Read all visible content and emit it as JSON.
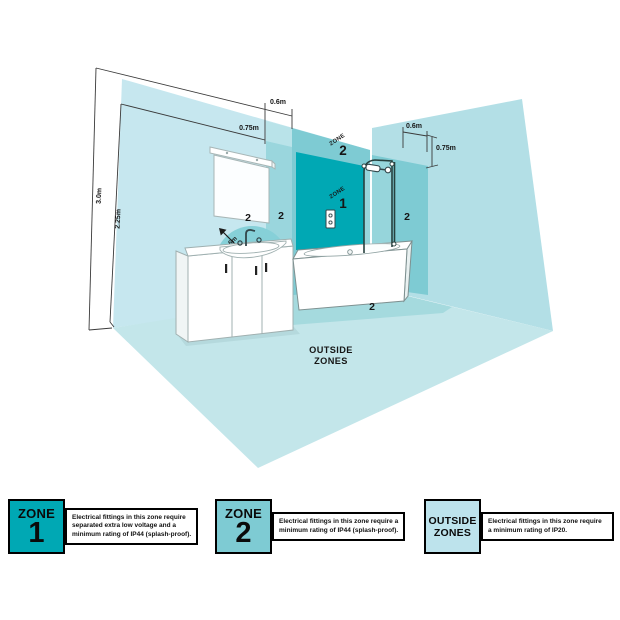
{
  "diagram": {
    "dimensions": {
      "left_top_width": "0.6m",
      "left_top_drop": "0.75m",
      "wall_height": "3.0m",
      "zone_height": "2.25m",
      "right_top_width": "0.6m",
      "right_top_drop": "0.75m",
      "basin_radius": "0.6m"
    },
    "zone1": {
      "word": "ZONE",
      "number": "1"
    },
    "zone2": {
      "word": "ZONE",
      "number": "2"
    },
    "markers": {
      "semicircle": "2",
      "left_strip": "2",
      "right_band": "2",
      "floor": "2"
    },
    "outside_zones": {
      "line1": "OUTSIDE",
      "line2": "ZONES"
    }
  },
  "legend": {
    "zone1": {
      "word": "ZONE",
      "number": "1",
      "lines": [
        "Electrical fittings in this zone require",
        "separated extra low voltage and a",
        "minimum rating of IP44 (splash-proof)."
      ]
    },
    "zone2": {
      "word": "ZONE",
      "number": "2",
      "lines": [
        "Electrical fittings in this zone require a",
        "minimum rating of IP44 (splash-proof)."
      ]
    },
    "outside": {
      "line1": "OUTSIDE",
      "line2": "ZONES",
      "lines": [
        "Electrical fittings in this zone require",
        "a minimum rating of IP20."
      ]
    }
  },
  "colors": {
    "zone1_teal": "#00a8b4",
    "zone2_teal": "#7ecbd3",
    "outside_light": "#bde3ec",
    "wall_light_blue": "#c6e7ef",
    "right_wall": "#b3dfe6",
    "floor": "#c3e6ea",
    "floor_band": "#a5dade"
  }
}
